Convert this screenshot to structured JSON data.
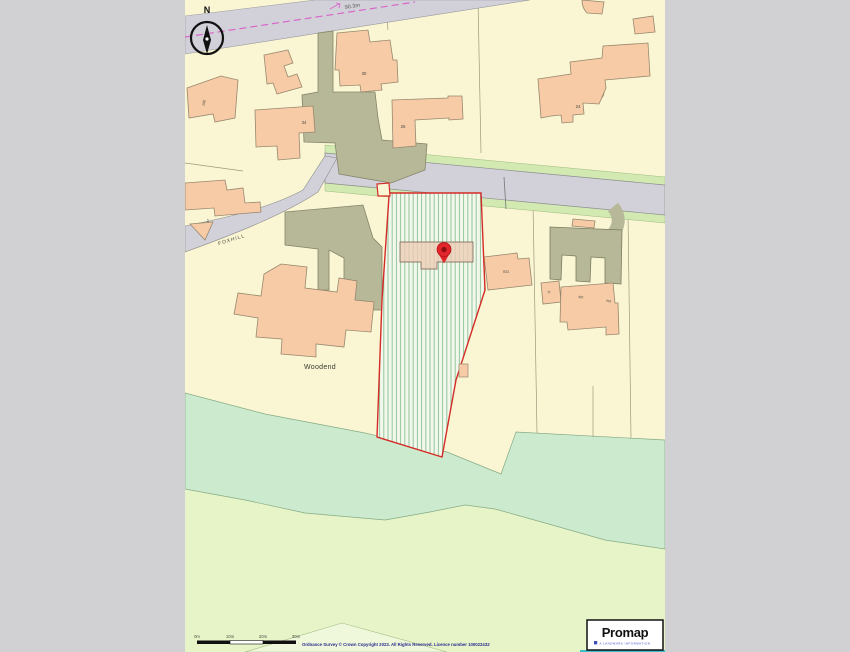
{
  "frame": {
    "background": "#d1d1d3"
  },
  "map": {
    "compass": {
      "label": "N"
    },
    "spot_height_label": "90.3m",
    "street_label": "FOXHILL",
    "property_label": "Woodend",
    "house_numbers": [
      "30",
      "34",
      "26",
      "24",
      "1",
      "10E",
      "R23",
      "J1",
      "18b",
      "18a"
    ],
    "colors": {
      "base_cream": "#faf6d3",
      "road_gray": "#d2d1da",
      "verge_green": "#d2eab2",
      "driveway_khaki": "#b7b898",
      "building_peach": "#f6cba6",
      "woodland_mint": "#cceacd",
      "field_green": "#e7f4c8",
      "plot_hatch_green": "#93c49a",
      "plot_boundary_red": "#d42b26",
      "marker_red": "#e0262a",
      "path_dash_pink": "#d966c9",
      "copyright_navy": "#2a2a8e"
    }
  },
  "footer": {
    "scale_labels": [
      "0m",
      "10m",
      "20m",
      "30m"
    ],
    "copyright": "Ordnance Survey © Crown Copyright 2023. All Rights Reserved. Licence number 100022432"
  },
  "logo": {
    "brand": "Promap",
    "tagline": "A LANDMARK INFORMATION"
  }
}
